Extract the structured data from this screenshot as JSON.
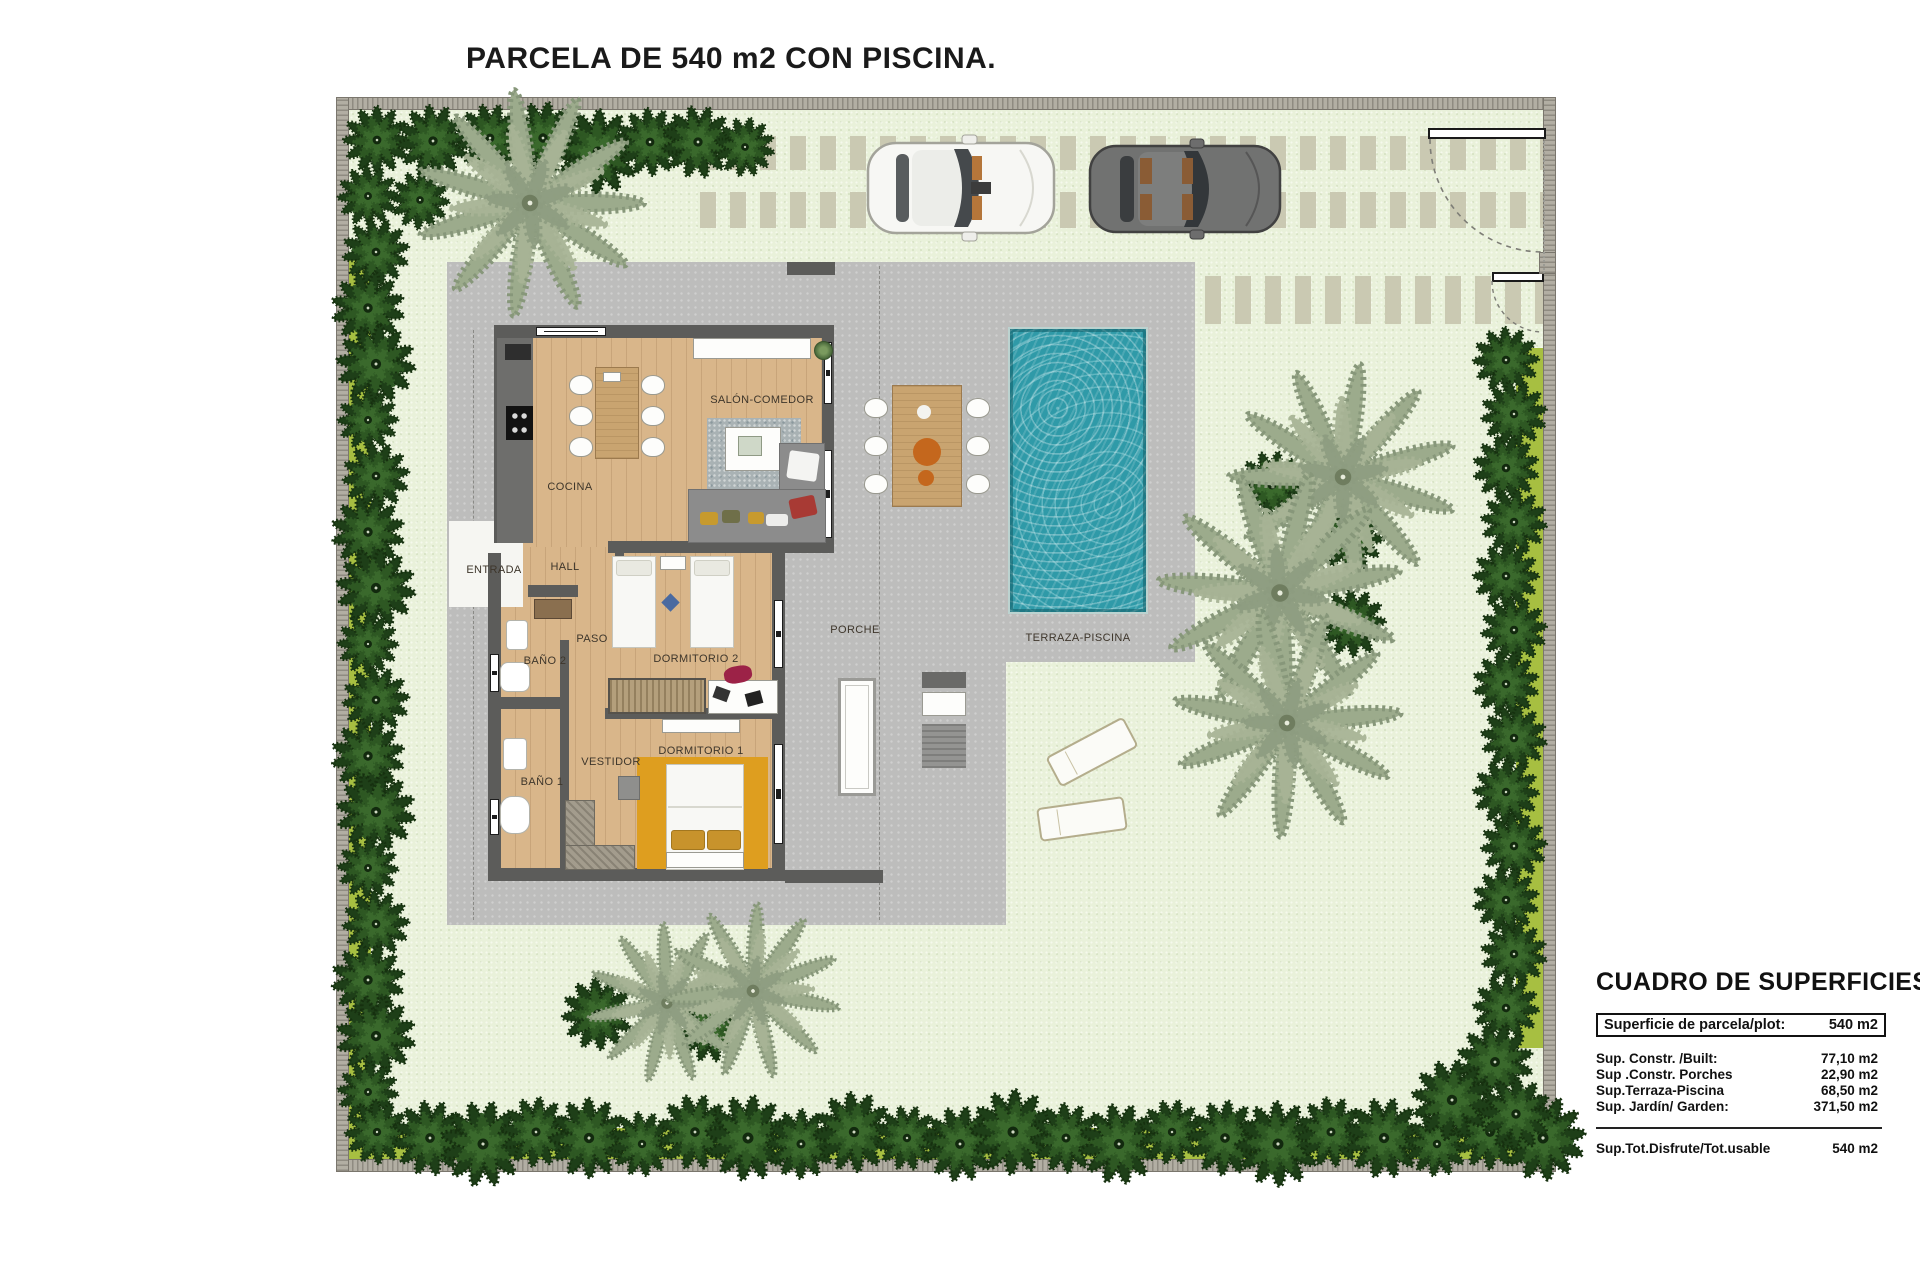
{
  "title": "PARCELA DE 540 m2 CON PISCINA.",
  "plan": {
    "rooms": [
      {
        "id": "cocina",
        "label": "COCINA"
      },
      {
        "id": "salon-comedor",
        "label": "SALÓN-COMEDOR"
      },
      {
        "id": "entrada",
        "label": "ENTRADA"
      },
      {
        "id": "hall",
        "label": "HALL"
      },
      {
        "id": "paso",
        "label": "PASO"
      },
      {
        "id": "bano-2",
        "label": "BAÑO 2"
      },
      {
        "id": "dormitorio-2",
        "label": "DORMITORIO 2"
      },
      {
        "id": "vestidor",
        "label": "VESTIDOR"
      },
      {
        "id": "bano-1",
        "label": "BAÑO 1"
      },
      {
        "id": "dormitorio-1",
        "label": "DORMITORIO 1"
      },
      {
        "id": "porche",
        "label": "PORCHE"
      },
      {
        "id": "terraza-piscina",
        "label": "TERRAZA-PISCINA"
      }
    ]
  },
  "surfaces_table": {
    "title": "CUADRO DE SUPERFICIES",
    "plot_row": {
      "label": "Superficie de parcela/plot:",
      "value": "540 m2"
    },
    "rows": [
      {
        "label": "Sup. Constr. /Built:",
        "value": "77,10 m2"
      },
      {
        "label": "Sup .Constr. Porches",
        "value": "22,90 m2"
      },
      {
        "label": "Sup.Terraza-Piscina",
        "value": "68,50 m2"
      },
      {
        "label": "Sup. Jardín/ Garden:",
        "value": "371,50 m2"
      }
    ],
    "total_row": {
      "label": "Sup.Tot.Disfrute/Tot.usable",
      "value": "540 m2"
    }
  },
  "colors": {
    "pool_water": "#2f9aa8",
    "terrace": "#bdbdbc",
    "garden": "#e9f1da",
    "hedge": "#24481c",
    "lawn_strip": "#a7bf41",
    "wood_floor": "#d9b68a"
  }
}
